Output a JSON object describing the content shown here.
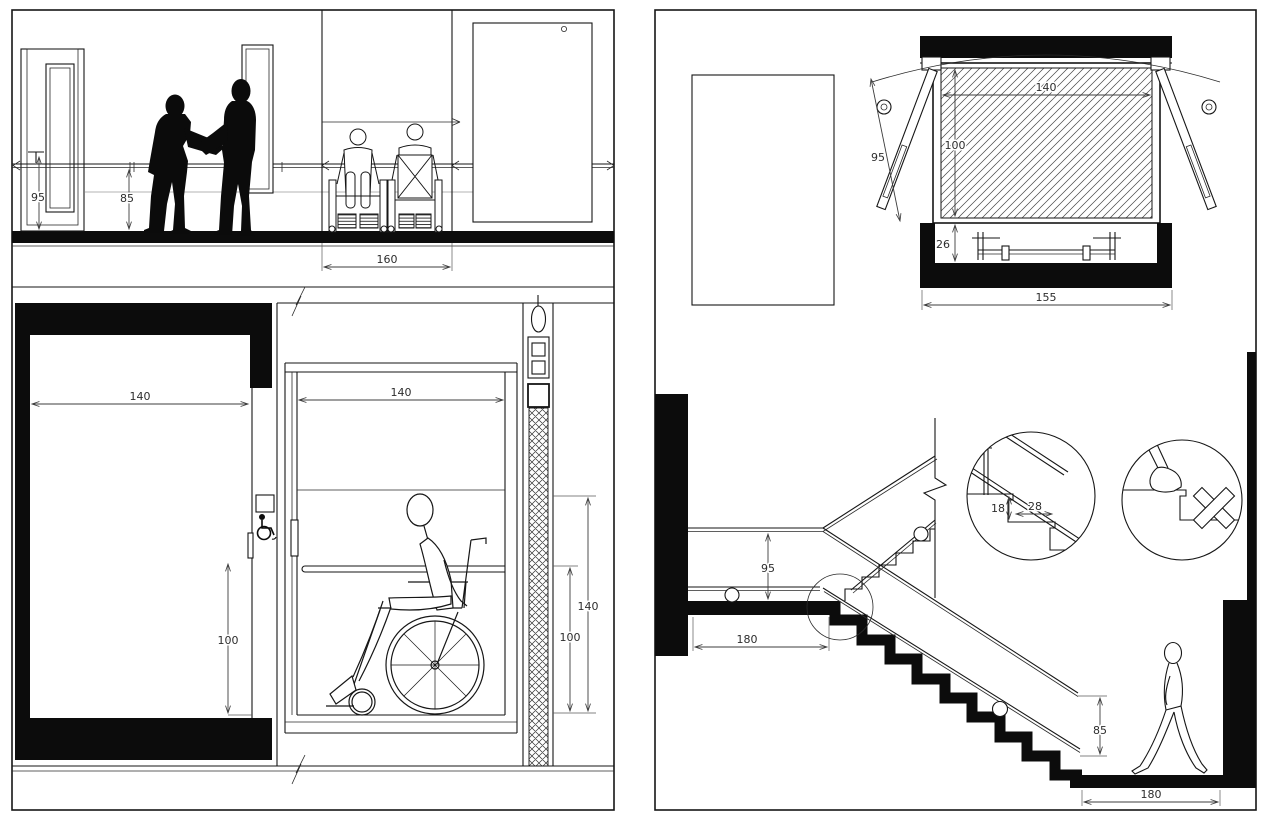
{
  "drawing_type": "accessibility-architectural-details",
  "views": {
    "corridor_elevation": {
      "title": "corridor elevation with handrail, standing people and wheelchair users",
      "dims": {
        "door_handle_height": "95",
        "handrail_height": "85",
        "wheelchair_passing_width": "160"
      }
    },
    "lift_section": {
      "title": "accessible lift vertical section with wheelchair user",
      "dims": {
        "landing_door_width": "140",
        "cab_width": "140",
        "call_button_height": "100",
        "cab_handrail_height": "100",
        "cab_door_height": "140"
      }
    },
    "lift_plan": {
      "title": "lift car plan with double swing doors",
      "dims": {
        "door_leaf_width": "95",
        "cab_width": "140",
        "cab_depth": "100",
        "sill_clearance": "26",
        "shaft_width": "155"
      }
    },
    "stair_section": {
      "title": "stair section with handrails, step detail and wrong-detail mark",
      "dims": {
        "landing_handrail_height": "95",
        "upper_landing_length": "180",
        "riser_height": "18",
        "tread_depth": "28",
        "flight_handrail_height": "85",
        "lower_landing_length": "180"
      }
    }
  }
}
